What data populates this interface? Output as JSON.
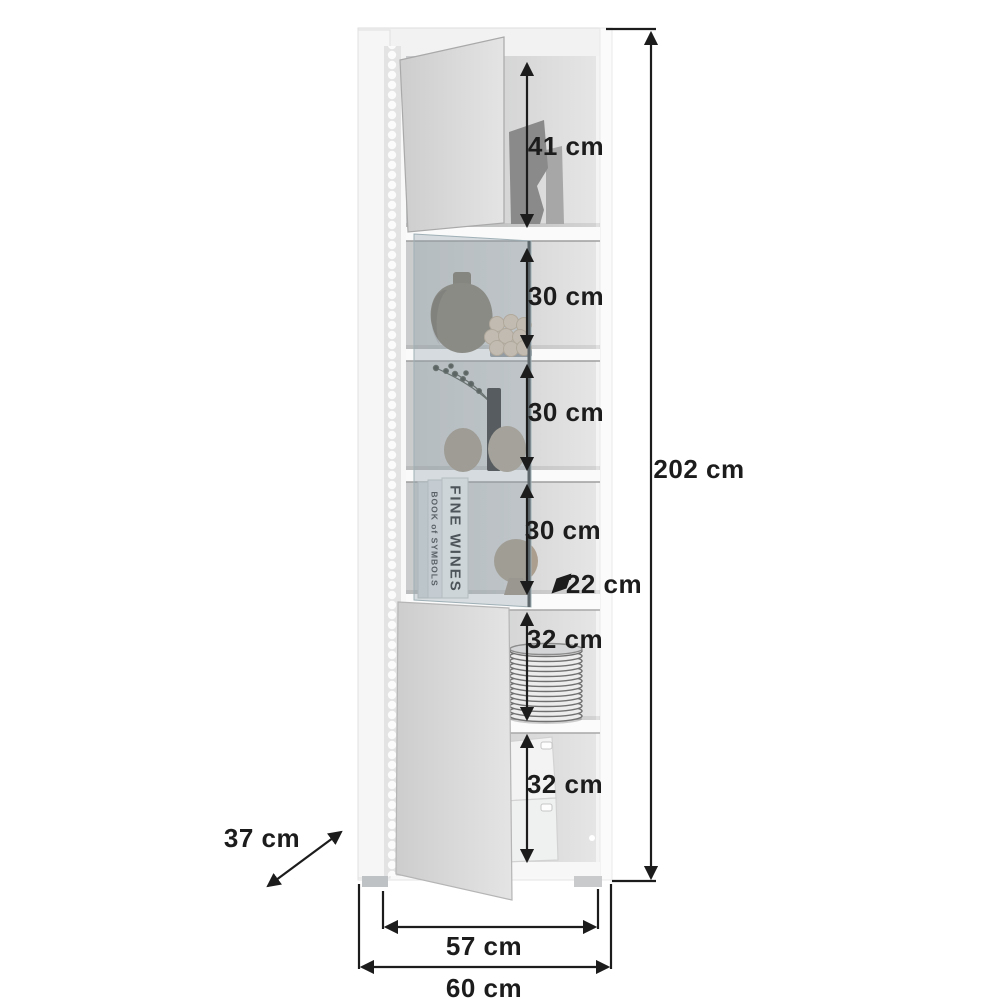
{
  "diagram": {
    "kind": "furniture-dimension-diagram"
  },
  "dimensions": {
    "total_height": "202 cm",
    "total_width": "60 cm",
    "total_depth": "37 cm",
    "inner_width": "57 cm",
    "top_compartment": "41 cm",
    "glass_shelf_1": "30 cm",
    "glass_shelf_2": "30 cm",
    "glass_shelf_3": "30 cm",
    "shelf_depth": "22 cm",
    "lower_compartment_1": "32 cm",
    "lower_compartment_2": "32 cm"
  },
  "decor": {
    "book_spine_main": "FINE WINES",
    "book_spine_secondary": "BOOK of SYMBOLS"
  },
  "colors": {
    "background": "#ffffff",
    "dimension_lines": "#1c1c1c",
    "cabinet_body": "#f7f7f7",
    "door_face": "#d9d9d9",
    "interior_back": "#d6d6d6",
    "glass_tint": "rgba(136,156,166,0.32)",
    "vase_taupe": "#9a9082",
    "plate_gray": "#ececec"
  }
}
